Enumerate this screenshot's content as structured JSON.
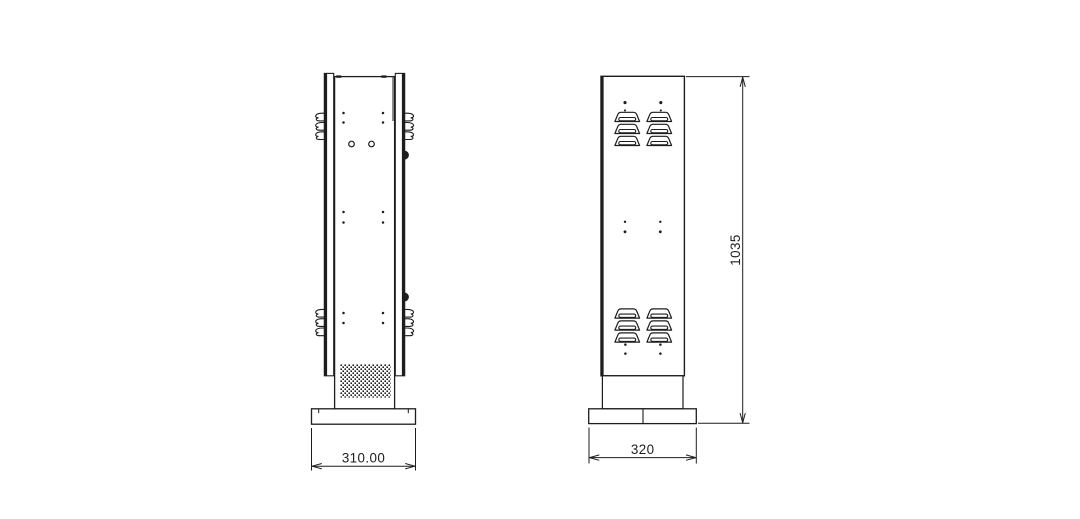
{
  "drawing": {
    "background_color": "#ffffff",
    "line_color": "#1d1d1d",
    "side_view": {
      "base_width_label": "310.00",
      "louvre_tab_groups": 2,
      "louvre_tabs_per_group_per_side": 3,
      "has_speaker_grille": true
    },
    "front_view": {
      "base_width_label": "320",
      "height_label": "1035",
      "louvre_columns": 2,
      "louvre_rows_top": 3,
      "louvre_rows_bottom": 3
    }
  }
}
